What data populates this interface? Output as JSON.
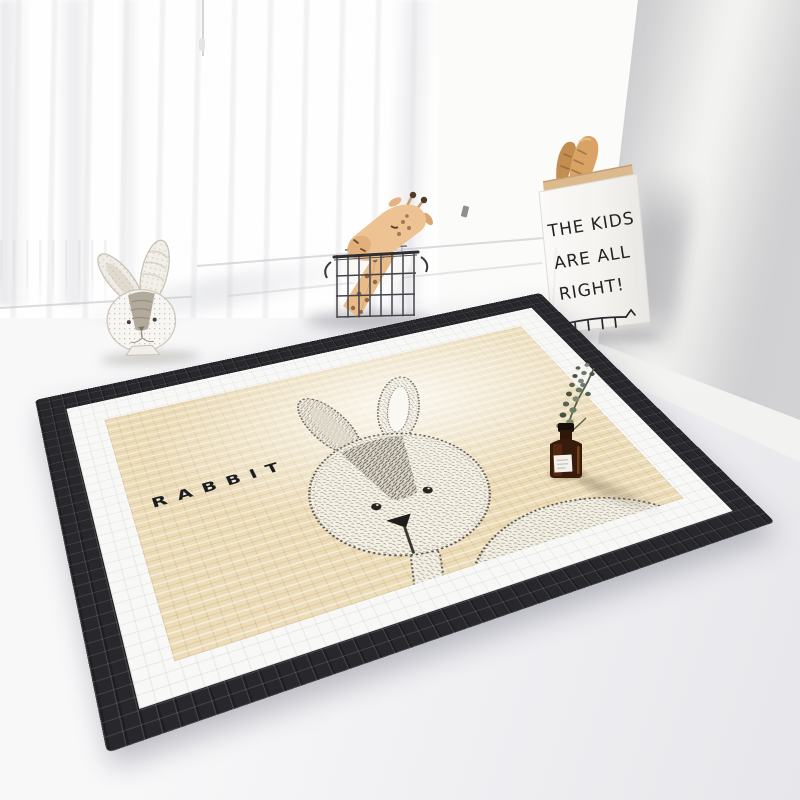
{
  "scene": {
    "rug": {
      "label": "RABBIT",
      "center_color": "#ecdcb8",
      "band_color": "#f8f8f6",
      "border_color": "#28282c"
    },
    "paper_bag": {
      "lines": [
        "THE KIDS",
        "ARE ALL",
        "RIGHT!"
      ]
    },
    "objects": {
      "rabbit_ornament": "rabbit head ornament",
      "wire_basket": "black wire basket",
      "giraffe": "giraffe plush",
      "baguettes": "baguettes in paper bag",
      "bottle": "amber bottle with eucalyptus sprig"
    },
    "palette": {
      "wall_gray": "#c9c9cb",
      "floor": "#f2f2f4",
      "giraffe_tan": "#eec394",
      "kraft_paper": "#dcba8e",
      "baguette": "#d9a365",
      "bottle_amber": "#381c0b",
      "eucalyptus": "#6e7a64"
    }
  }
}
